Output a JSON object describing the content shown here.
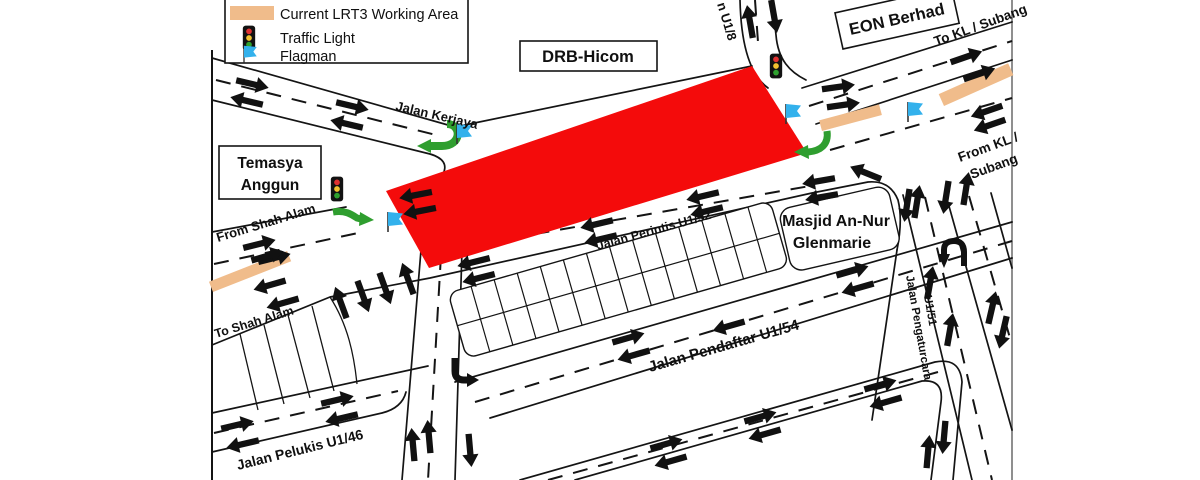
{
  "legend": {
    "items": [
      {
        "icon": "working-area-swatch",
        "label": "Current LRT3 Working Area"
      },
      {
        "icon": "traffic-light",
        "label": "Traffic Light"
      },
      {
        "icon": "flag",
        "label": "Flagman"
      }
    ]
  },
  "labels": {
    "drb_hicom": "DRB-Hicom",
    "eon_berhad": "EON Berhad",
    "temasya_line1": "Temasya",
    "temasya_line2": "Anggun",
    "masjid_line1": "Masjid An-Nur",
    "masjid_line2": "Glenmarie",
    "jalan_kerjaya": "Jalan Kerjaya",
    "from_shah_alam": "From Shah Alam",
    "to_shah_alam": "To Shah Alam",
    "jalan_perintis": "Jalan Perintis U1/52",
    "jalan_pendaftar": "Jalan Pendaftar U1/54",
    "jalan_pelukis": "Jalan Pelukis U1/46",
    "jalan_pengaturcara_line1": "Jalan Pengaturcara",
    "jalan_pengaturcara_line2": "U1/51",
    "persiaran_u18": "n U1/8",
    "to_kl_subang": "To KL / Subang",
    "from_kl_line1": "From KL /",
    "from_kl_line2": "Subang"
  },
  "colors": {
    "working_area": "#f0bc8b",
    "road_closure": "#f40b0b",
    "diversion_arrow": "#2f9e2f",
    "flag": "#33b1ec",
    "traffic_light_red": "#e03131",
    "traffic_light_yellow": "#f2c230",
    "traffic_light_green": "#2fa12f",
    "traffic_light_body": "#121212",
    "arrow_black": "#111111"
  }
}
